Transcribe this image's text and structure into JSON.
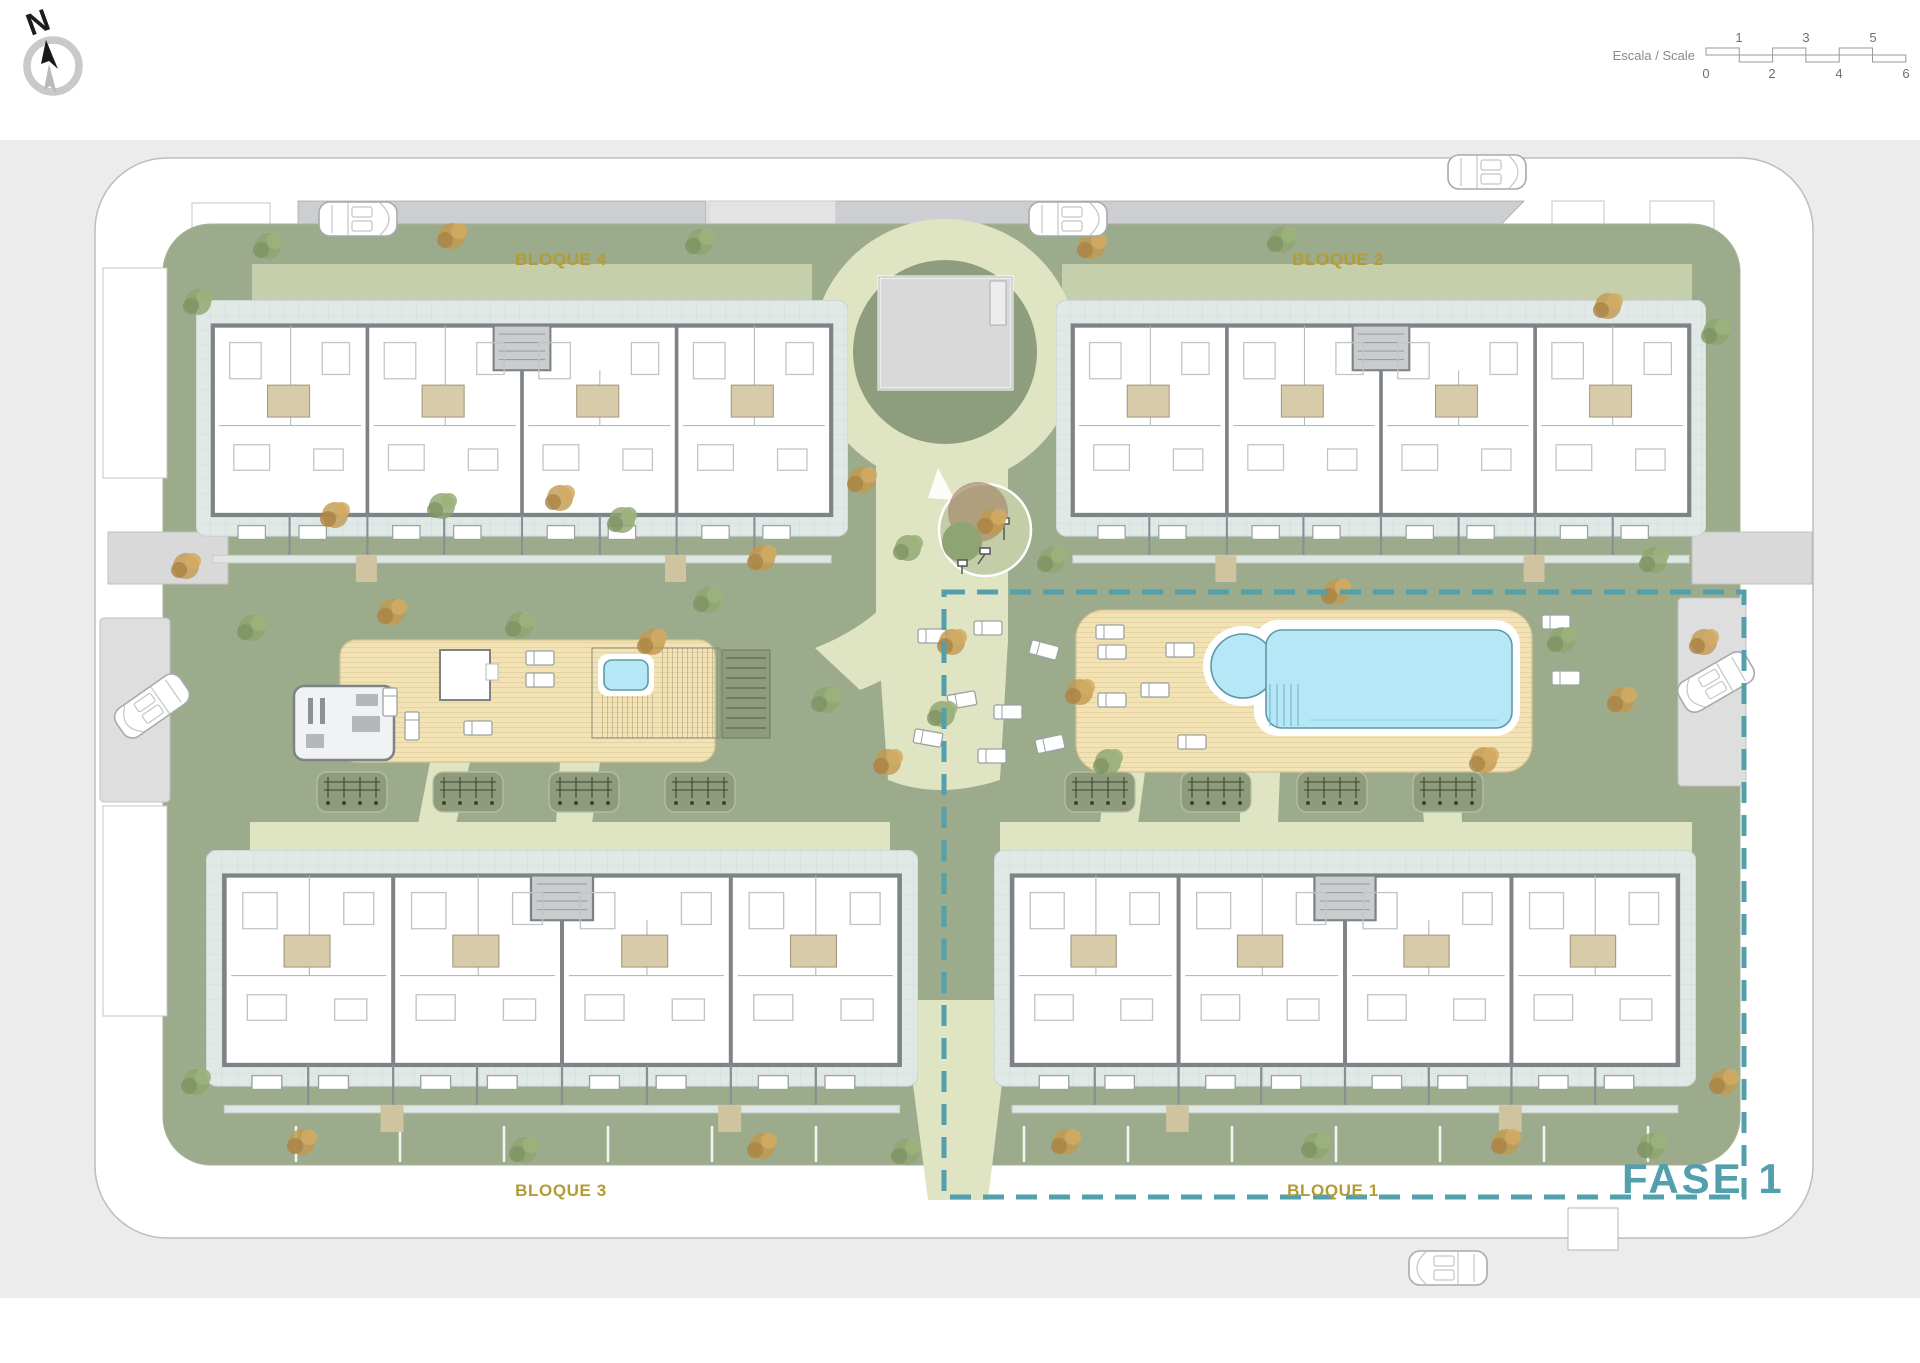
{
  "compass": {
    "north_label": "N"
  },
  "scale_bar": {
    "label": "Escala / Scale",
    "top_ticks": [
      "1",
      "3",
      "5"
    ],
    "bottom_ticks": [
      "0",
      "2",
      "4",
      "6"
    ]
  },
  "blocks": {
    "bloque4": "BLOQUE 4",
    "bloque2": "BLOQUE 2",
    "bloque3": "BLOQUE 3",
    "bloque1": "BLOQUE 1"
  },
  "phase": {
    "label": "FASE 1"
  },
  "colors": {
    "canvas_gray": "#ececec",
    "road_gray": "#cdced2",
    "lawn_green": "#9cab8b",
    "lawn_band": "#c6cfab",
    "path_cream": "#dfe4c3",
    "paving_blue_gray": "#e1e9e7",
    "deck_tan": "#f2e2b4",
    "pool_blue": "#b5e7f7",
    "wall_gray": "#7e8387",
    "bath_tan": "#d8cba9",
    "label_gold": "#b49b33",
    "phase_teal": "#53a0ac"
  }
}
